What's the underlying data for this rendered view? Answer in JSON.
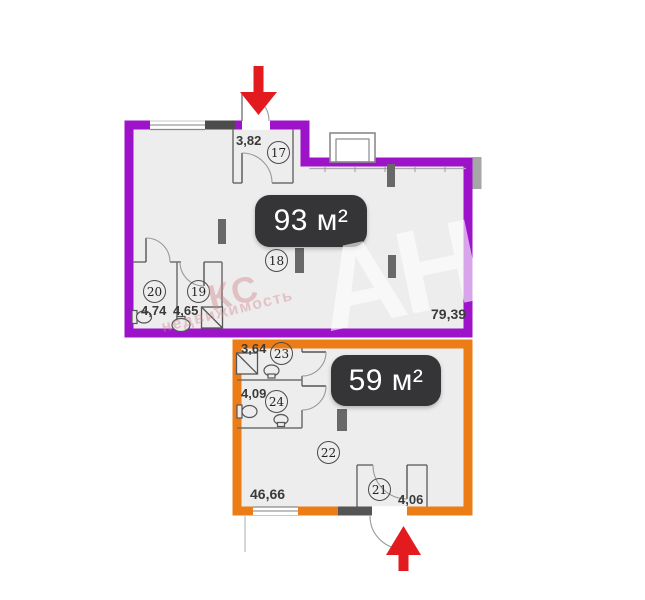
{
  "apt93": {
    "badge": "93 м²",
    "floor_area": "79,39",
    "outline_color": "#9c13c9",
    "rooms": {
      "r17": {
        "num": "17",
        "dim": "3,82"
      },
      "r18": {
        "num": "18"
      },
      "r19": {
        "num": "19",
        "dim": "4,65"
      },
      "r20": {
        "num": "20",
        "dim": "4,74"
      }
    }
  },
  "apt59": {
    "badge": "59 м²",
    "floor_area": "46,66",
    "outline_color": "#ec7c15",
    "rooms": {
      "r21": {
        "num": "21",
        "dim": "4,06"
      },
      "r22": {
        "num": "22"
      },
      "r23": {
        "num": "23",
        "dim": "3,64"
      },
      "r24": {
        "num": "24",
        "dim": "4,09"
      }
    }
  },
  "icons": {
    "entry_arrow_top": "arrow-down-entry",
    "entry_arrow_bottom": "arrow-up-entry",
    "entry_arrow_color": "#e31b1f"
  },
  "watermark": {
    "agency_initials": "АН",
    "brand": "КС",
    "brand_sub": "недвижимость"
  },
  "colors": {
    "interior_fill": "#ededed",
    "badge_bg": "#353538",
    "wall_line": "#6f6f6f"
  }
}
